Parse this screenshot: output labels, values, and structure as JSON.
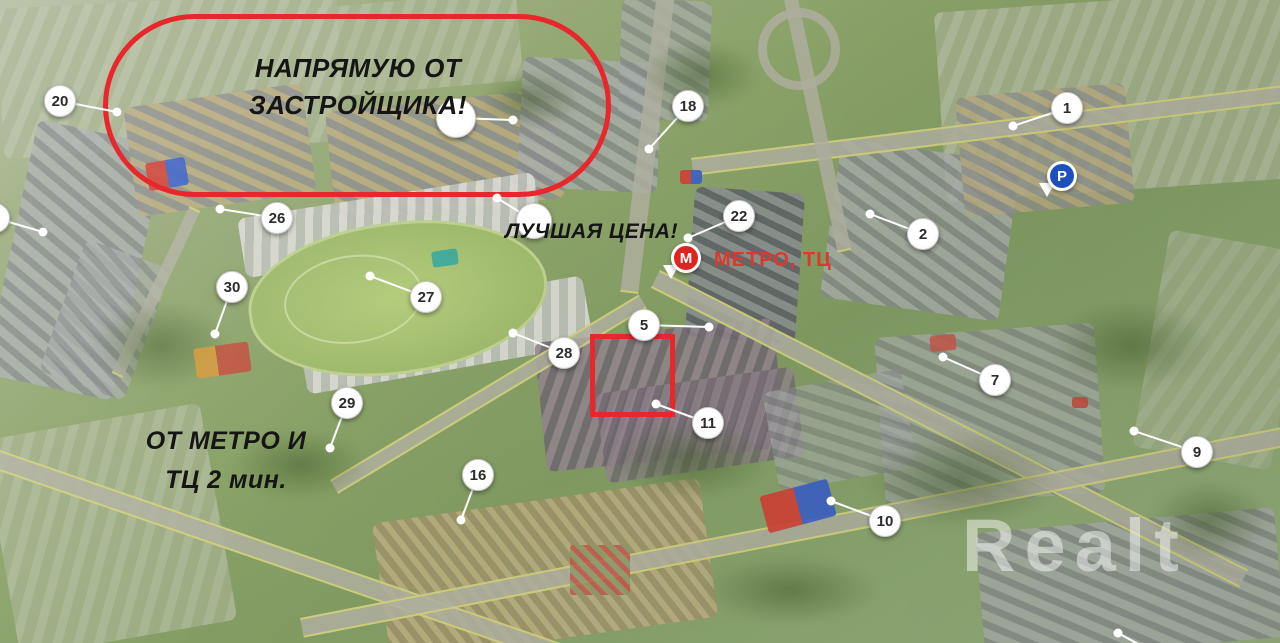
{
  "map": {
    "watermark": "Realt",
    "annotations": {
      "developer": {
        "line1": "НАПРЯМУЮ ОТ",
        "line2": "ЗАСТРОЙЩИКА!"
      },
      "best_price": "ЛУЧШАЯ ЦЕНА!",
      "metro_mall": "МЕТРО, ТЦ",
      "metro_walk": {
        "line1": "ОТ МЕТРО И",
        "line2": "ТЦ 2 мин."
      }
    },
    "colors": {
      "highlight_red": "#e8262b",
      "metro_red": "#e0231e",
      "label_red": "#e0372c",
      "parking_blue": "#1d50bd"
    },
    "pins": {
      "metro": {
        "letter": "М",
        "x": 686,
        "y": 258
      },
      "parking": {
        "letter": "P",
        "x": 1062,
        "y": 176
      }
    },
    "markers": [
      {
        "label": "20",
        "cx": 60,
        "cy": 101,
        "dx": 117,
        "dy": 112
      },
      {
        "label": "26",
        "cx": 277,
        "cy": 218,
        "dx": 220,
        "dy": 209
      },
      {
        "label": "30",
        "cx": 232,
        "cy": 287,
        "dx": 215,
        "dy": 334
      },
      {
        "label": "27",
        "cx": 426,
        "cy": 297,
        "dx": 370,
        "dy": 276
      },
      {
        "label": "28",
        "cx": 564,
        "cy": 353,
        "dx": 513,
        "dy": 333
      },
      {
        "label": "29",
        "cx": 347,
        "cy": 403,
        "dx": 330,
        "dy": 448
      },
      {
        "label": "16",
        "cx": 478,
        "cy": 475,
        "dx": 461,
        "dy": 520
      },
      {
        "label": "5",
        "cx": 644,
        "cy": 325,
        "dx": 709,
        "dy": 327
      },
      {
        "label": "11",
        "cx": 708,
        "cy": 423,
        "dx": 656,
        "dy": 404
      },
      {
        "label": "18",
        "cx": 688,
        "cy": 106,
        "dx": 649,
        "dy": 149
      },
      {
        "label": "22",
        "cx": 739,
        "cy": 216,
        "dx": 688,
        "dy": 238
      },
      {
        "label": "2",
        "cx": 923,
        "cy": 234,
        "dx": 870,
        "dy": 214
      },
      {
        "label": "1",
        "cx": 1067,
        "cy": 108,
        "dx": 1013,
        "dy": 126
      },
      {
        "label": "7",
        "cx": 995,
        "cy": 380,
        "dx": 943,
        "dy": 357
      },
      {
        "label": "9",
        "cx": 1197,
        "cy": 452,
        "dx": 1134,
        "dy": 431
      },
      {
        "label": "10",
        "cx": 885,
        "cy": 521,
        "dx": 831,
        "dy": 501
      }
    ],
    "unnumbered_markers": [
      {
        "cx": 456,
        "cy": 118,
        "dx": 513,
        "dy": 120,
        "r": 20
      },
      {
        "cx": 534,
        "cy": 221,
        "dx": 497,
        "dy": 198,
        "r": 18
      },
      {
        "cx": -5,
        "cy": 218,
        "dx": 43,
        "dy": 232,
        "r": 15
      }
    ],
    "edge_leader": {
      "x1": 1118,
      "y1": 633,
      "x2": 1160,
      "y2": 656
    }
  }
}
